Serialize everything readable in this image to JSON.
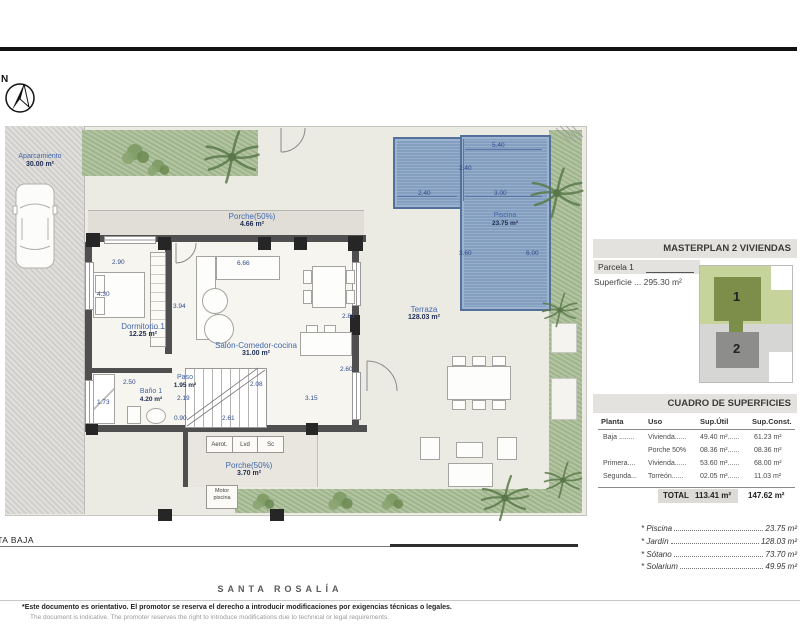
{
  "compass": {
    "north_label": "N"
  },
  "plan": {
    "aparcamiento": {
      "name": "Aparcamiento",
      "area": "30.00 m²"
    },
    "rooms": {
      "porche_top": {
        "name": "Porche(50%)",
        "area": "4.66 m²"
      },
      "dormitorio": {
        "name": "Dormitorio 1",
        "area": "12.25 m²"
      },
      "salon": {
        "name": "Salón-Comedor-cocina",
        "area": "31.00 m²"
      },
      "paso": {
        "name": "Paso",
        "area": "1.95 m²"
      },
      "bano": {
        "name": "Baño 1",
        "area": "4.20 m²"
      },
      "porche_bottom": {
        "name": "Porche(50%)",
        "area": "3.70 m²"
      },
      "terraza": {
        "name": "Terraza",
        "area": "128.03 m²"
      },
      "piscina": {
        "name": "Piscina",
        "area": "23.75 m²"
      }
    },
    "cabinets": [
      "Aerot.",
      "Lvd",
      "Sc"
    ],
    "motor_label": "Motor piscina",
    "dimensions": [
      "2.90",
      "4.30",
      "3.94",
      "6.66",
      "2.83",
      "2.60",
      "2.08",
      "2.19",
      "0.90",
      "2.61",
      "3.15",
      "2.50",
      "1.73",
      "5.40",
      "2.40",
      "2.40",
      "3.00",
      "3.60",
      "6.00"
    ],
    "floor_label": "PLANTA BAJA"
  },
  "masterplan": {
    "title": "MASTERPLAN 2 VIVIENDAS",
    "parcela": "Parcela 1",
    "superficie": "Superficie ... 295.30 m²",
    "unit1": "1",
    "unit2": "2"
  },
  "cuadro": {
    "title": "CUADRO DE SUPERFICIES",
    "headers": [
      "Planta",
      "Uso",
      "Sup.Útil",
      "Sup.Const."
    ],
    "rows": [
      [
        "Baja ........",
        "Vivienda......",
        "49.40 m²......",
        "61.23 m²"
      ],
      [
        "",
        "Porche 50%",
        "08.36 m²......",
        "08.36 m²"
      ],
      [
        "Primera....",
        "Vivienda......",
        "53.60 m²......",
        "68.00 m²"
      ],
      [
        "Segunda...",
        "Torreón......",
        "02.05 m²......",
        "11.03 m²"
      ]
    ],
    "total_label": "TOTAL",
    "total_util": "113.41 m²",
    "total_const": "147.62 m²"
  },
  "extras": [
    {
      "label": "* Piscina",
      "value": "23.75 m²"
    },
    {
      "label": "* Jardín",
      "value": "128.03 m²"
    },
    {
      "label": "* Sótano",
      "value": "73.70 m²"
    },
    {
      "label": "* Solarium",
      "value": "49.95 m²"
    }
  ],
  "branding": {
    "name": "SANTA ROSALÍA"
  },
  "footer": {
    "line1": "*Este documento es orientativo. El promotor se reserva el derecho a introducir modificaciones por exigencias técnicas o legales.",
    "line2": "The document is indicative. The promoter reserves the right to introduce modifications due to technical or legal requirements."
  },
  "colors": {
    "pool": "#8ba5c6",
    "grass": "#a9bd96",
    "wall": "#4f4f4f",
    "accent_blue": "#3f63ac",
    "panel_bar": "#e3e2df"
  }
}
